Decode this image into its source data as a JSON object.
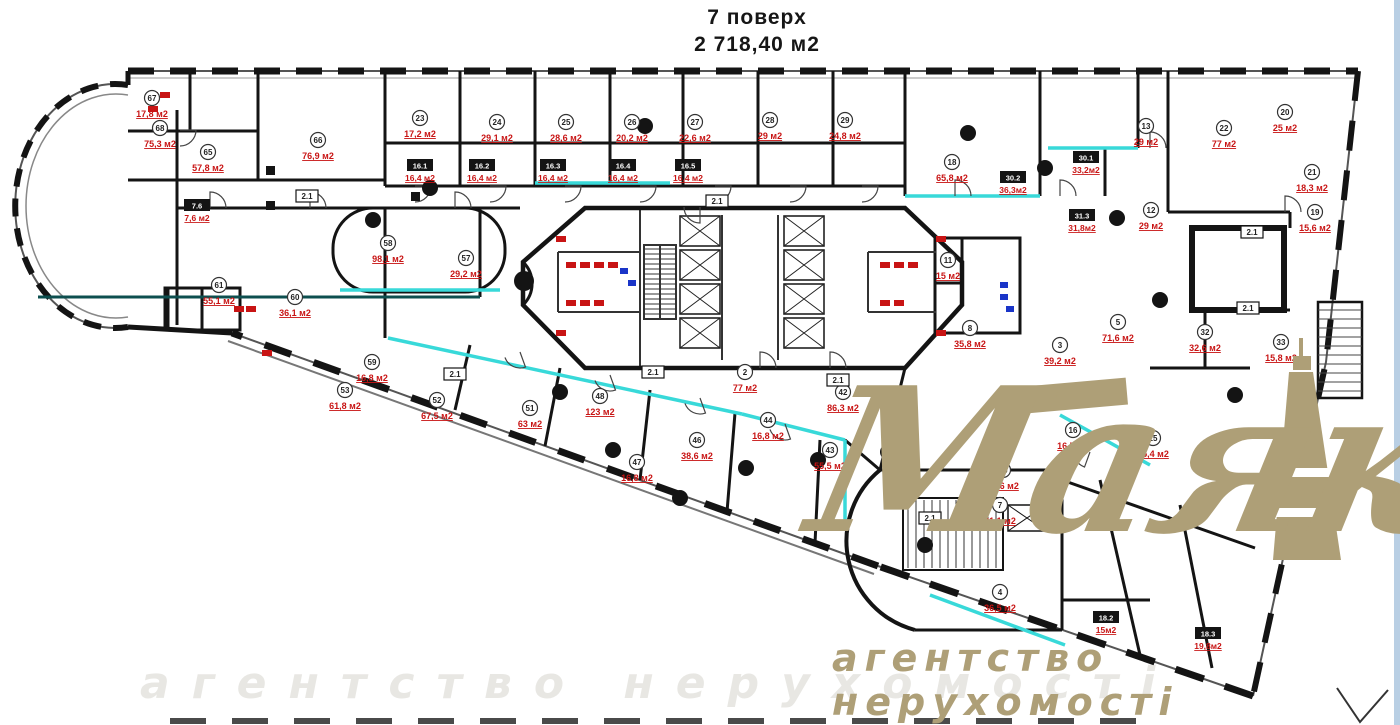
{
  "title": {
    "floor": "7 поверх",
    "total_area": "2 718,40 м2"
  },
  "watermark": {
    "brand": "Маяк",
    "tagline": "агентство нерухомості",
    "ghost_tagline": "агентство нерухомості",
    "color": "#ae9f77"
  },
  "plan": {
    "colors": {
      "wall": "#141414",
      "wall_soft": "#3a3a3a",
      "cyan": "#38d9d9",
      "teal_dark": "#0d4f4f",
      "red": "#c81414",
      "blue": "#1a35c8",
      "gold": "#ae9f77",
      "edge_strip": "#b9cfe4"
    },
    "rooms": [
      {
        "num": "67",
        "area": "17,8 м2",
        "x": 152,
        "y": 98
      },
      {
        "num": "68",
        "area": "75,3 м2",
        "x": 160,
        "y": 128
      },
      {
        "num": "65",
        "area": "57,8 м2",
        "x": 208,
        "y": 152
      },
      {
        "num": "66",
        "area": "76,9 м2",
        "x": 318,
        "y": 140
      },
      {
        "num": "23",
        "area": "17,2 м2",
        "x": 420,
        "y": 118
      },
      {
        "num": "24",
        "area": "29,1 м2",
        "x": 497,
        "y": 122
      },
      {
        "num": "25",
        "area": "28,6 м2",
        "x": 566,
        "y": 122
      },
      {
        "num": "26",
        "area": "20,2 м2",
        "x": 632,
        "y": 122
      },
      {
        "num": "27",
        "area": "22,6 м2",
        "x": 695,
        "y": 122
      },
      {
        "num": "28",
        "area": "29 м2",
        "x": 770,
        "y": 120
      },
      {
        "num": "29",
        "area": "24,8 м2",
        "x": 845,
        "y": 120
      },
      {
        "num": "18",
        "area": "65,8 м2",
        "x": 952,
        "y": 162
      },
      {
        "num": "13",
        "area": "29 м2",
        "x": 1146,
        "y": 126
      },
      {
        "num": "22",
        "area": "77 м2",
        "x": 1224,
        "y": 128
      },
      {
        "num": "20",
        "area": "25 м2",
        "x": 1285,
        "y": 112
      },
      {
        "num": "21",
        "area": "18,3 м2",
        "x": 1312,
        "y": 172
      },
      {
        "num": "19",
        "area": "15,6 м2",
        "x": 1315,
        "y": 212
      },
      {
        "num": "12",
        "area": "29 м2",
        "x": 1151,
        "y": 210
      },
      {
        "num": "58",
        "area": "98,1 м2",
        "x": 388,
        "y": 243
      },
      {
        "num": "57",
        "area": "29,2 м2",
        "x": 466,
        "y": 258
      },
      {
        "num": "61",
        "area": "55,1 м2",
        "x": 219,
        "y": 285
      },
      {
        "num": "60",
        "area": "36,1 м2",
        "x": 295,
        "y": 297
      },
      {
        "num": "59",
        "area": "16,8 м2",
        "x": 372,
        "y": 362
      },
      {
        "num": "53",
        "area": "61,8 м2",
        "x": 345,
        "y": 390
      },
      {
        "num": "52",
        "area": "67,5 м2",
        "x": 437,
        "y": 400
      },
      {
        "num": "51",
        "area": "63 м2",
        "x": 530,
        "y": 408
      },
      {
        "num": "48",
        "area": "123 м2",
        "x": 600,
        "y": 396
      },
      {
        "num": "47",
        "area": "16,8 м2",
        "x": 637,
        "y": 462
      },
      {
        "num": "46",
        "area": "38,6 м2",
        "x": 697,
        "y": 440
      },
      {
        "num": "44",
        "area": "16,8 м2",
        "x": 768,
        "y": 420
      },
      {
        "num": "43",
        "area": "55,5 м2",
        "x": 830,
        "y": 450
      },
      {
        "num": "42",
        "area": "86,3 м2",
        "x": 843,
        "y": 392
      },
      {
        "num": "2",
        "area": "77 м2",
        "x": 745,
        "y": 372
      },
      {
        "num": "11",
        "area": "15 м2",
        "x": 948,
        "y": 260
      },
      {
        "num": "8",
        "area": "35,8 м2",
        "x": 970,
        "y": 328
      },
      {
        "num": "3",
        "area": "39,2 м2",
        "x": 1060,
        "y": 345
      },
      {
        "num": "5",
        "area": "71,6 м2",
        "x": 1118,
        "y": 322
      },
      {
        "num": "32",
        "area": "32,6 м2",
        "x": 1205,
        "y": 332
      },
      {
        "num": "33",
        "area": "15,8 м2",
        "x": 1281,
        "y": 342
      },
      {
        "num": "15",
        "area": "36,6 м2",
        "x": 1003,
        "y": 470
      },
      {
        "num": "16",
        "area": "16,7 м2",
        "x": 1073,
        "y": 430
      },
      {
        "num": "25",
        "area": "55,4 м2",
        "x": 1153,
        "y": 438
      },
      {
        "num": "7",
        "area": "21,1 м2",
        "x": 1000,
        "y": 505
      },
      {
        "num": "4",
        "area": "36,5 м2",
        "x": 1000,
        "y": 592
      }
    ],
    "tag_rooms": [
      {
        "tag": "30.2",
        "area": "36,3м2",
        "x": 1013,
        "y": 178
      },
      {
        "tag": "30.1",
        "area": "33,2м2",
        "x": 1086,
        "y": 158
      },
      {
        "tag": "31.3",
        "area": "31,8м2",
        "x": 1082,
        "y": 216
      },
      {
        "tag": "18.2",
        "area": "15м2",
        "x": 1106,
        "y": 618
      },
      {
        "tag": "18.3",
        "area": "19,8м2",
        "x": 1208,
        "y": 634
      },
      {
        "tag": "16.1",
        "area": "16,4 м2",
        "x": 420,
        "y": 166
      },
      {
        "tag": "16.2",
        "area": "16,4 м2",
        "x": 482,
        "y": 166
      },
      {
        "tag": "16.3",
        "area": "16,4 м2",
        "x": 553,
        "y": 166
      },
      {
        "tag": "16.4",
        "area": "16,4 м2",
        "x": 623,
        "y": 166
      },
      {
        "tag": "16.5",
        "area": "16,4 м2",
        "x": 688,
        "y": 166
      },
      {
        "tag": "7.6",
        "area": "7,6 м2",
        "x": 197,
        "y": 206
      }
    ],
    "corridor_tags": [
      {
        "label": "2.1",
        "x": 717,
        "y": 201
      },
      {
        "label": "2.1",
        "x": 653,
        "y": 372
      },
      {
        "label": "2.1",
        "x": 1252,
        "y": 232
      },
      {
        "label": "2.1",
        "x": 1248,
        "y": 308
      },
      {
        "label": "2.1",
        "x": 930,
        "y": 518
      },
      {
        "label": "2.1",
        "x": 838,
        "y": 380
      },
      {
        "label": "2.1",
        "x": 307,
        "y": 196
      },
      {
        "label": "2.1",
        "x": 455,
        "y": 374
      }
    ],
    "columns": [
      [
        968,
        133
      ],
      [
        1045,
        168
      ],
      [
        1117,
        218
      ],
      [
        746,
        468
      ],
      [
        818,
        460
      ],
      [
        888,
        452
      ],
      [
        645,
        126
      ],
      [
        430,
        188
      ],
      [
        373,
        220
      ],
      [
        1160,
        300
      ],
      [
        1050,
        480
      ],
      [
        925,
        545
      ],
      [
        613,
        450
      ],
      [
        560,
        392
      ],
      [
        680,
        498
      ],
      [
        1235,
        395
      ]
    ],
    "squares": [
      [
        270,
        170
      ],
      [
        270,
        205
      ],
      [
        415,
        196
      ]
    ],
    "cyan_walls": [
      [
        535,
        183,
        670,
        183
      ],
      [
        905,
        196,
        1040,
        196
      ],
      [
        1048,
        148,
        1138,
        148
      ],
      [
        388,
        338,
        742,
        414
      ],
      [
        742,
        414,
        845,
        440
      ],
      [
        845,
        440,
        845,
        520
      ],
      [
        1060,
        415,
        1150,
        465
      ],
      [
        930,
        595,
        1065,
        645
      ],
      [
        340,
        290,
        500,
        290
      ]
    ],
    "teal_wall": [
      38,
      297,
      480,
      297
    ],
    "doors": [
      [
        415,
        186,
        90
      ],
      [
        490,
        186,
        90
      ],
      [
        565,
        186,
        90
      ],
      [
        640,
        186,
        90
      ],
      [
        715,
        186,
        90
      ],
      [
        790,
        186,
        90
      ],
      [
        862,
        186,
        90
      ],
      [
        210,
        208,
        0
      ],
      [
        310,
        208,
        0
      ],
      [
        455,
        208,
        0
      ],
      [
        1060,
        196,
        0
      ],
      [
        955,
        196,
        0
      ],
      [
        1150,
        148,
        0
      ],
      [
        1285,
        212,
        0
      ],
      [
        520,
        352,
        160
      ],
      [
        610,
        375,
        160
      ],
      [
        700,
        398,
        160
      ],
      [
        785,
        424,
        160
      ],
      [
        760,
        368,
        0
      ],
      [
        830,
        368,
        0
      ],
      [
        700,
        207,
        180
      ],
      [
        180,
        130,
        90
      ],
      [
        1090,
        452,
        200
      ],
      [
        1010,
        415,
        70
      ]
    ],
    "fixtures_red": [
      [
        566,
        262
      ],
      [
        580,
        262
      ],
      [
        594,
        262
      ],
      [
        608,
        262
      ],
      [
        566,
        300
      ],
      [
        580,
        300
      ],
      [
        594,
        300
      ],
      [
        880,
        262
      ],
      [
        894,
        262
      ],
      [
        908,
        262
      ],
      [
        880,
        300
      ],
      [
        894,
        300
      ],
      [
        148,
        92
      ],
      [
        160,
        92
      ],
      [
        148,
        106
      ],
      [
        234,
        306
      ],
      [
        246,
        306
      ],
      [
        556,
        236
      ],
      [
        556,
        330
      ],
      [
        936,
        236
      ],
      [
        936,
        330
      ],
      [
        262,
        350
      ]
    ],
    "fixtures_blue": [
      [
        1000,
        282
      ],
      [
        1000,
        294
      ],
      [
        1006,
        306
      ],
      [
        620,
        268
      ],
      [
        628,
        280
      ]
    ]
  }
}
